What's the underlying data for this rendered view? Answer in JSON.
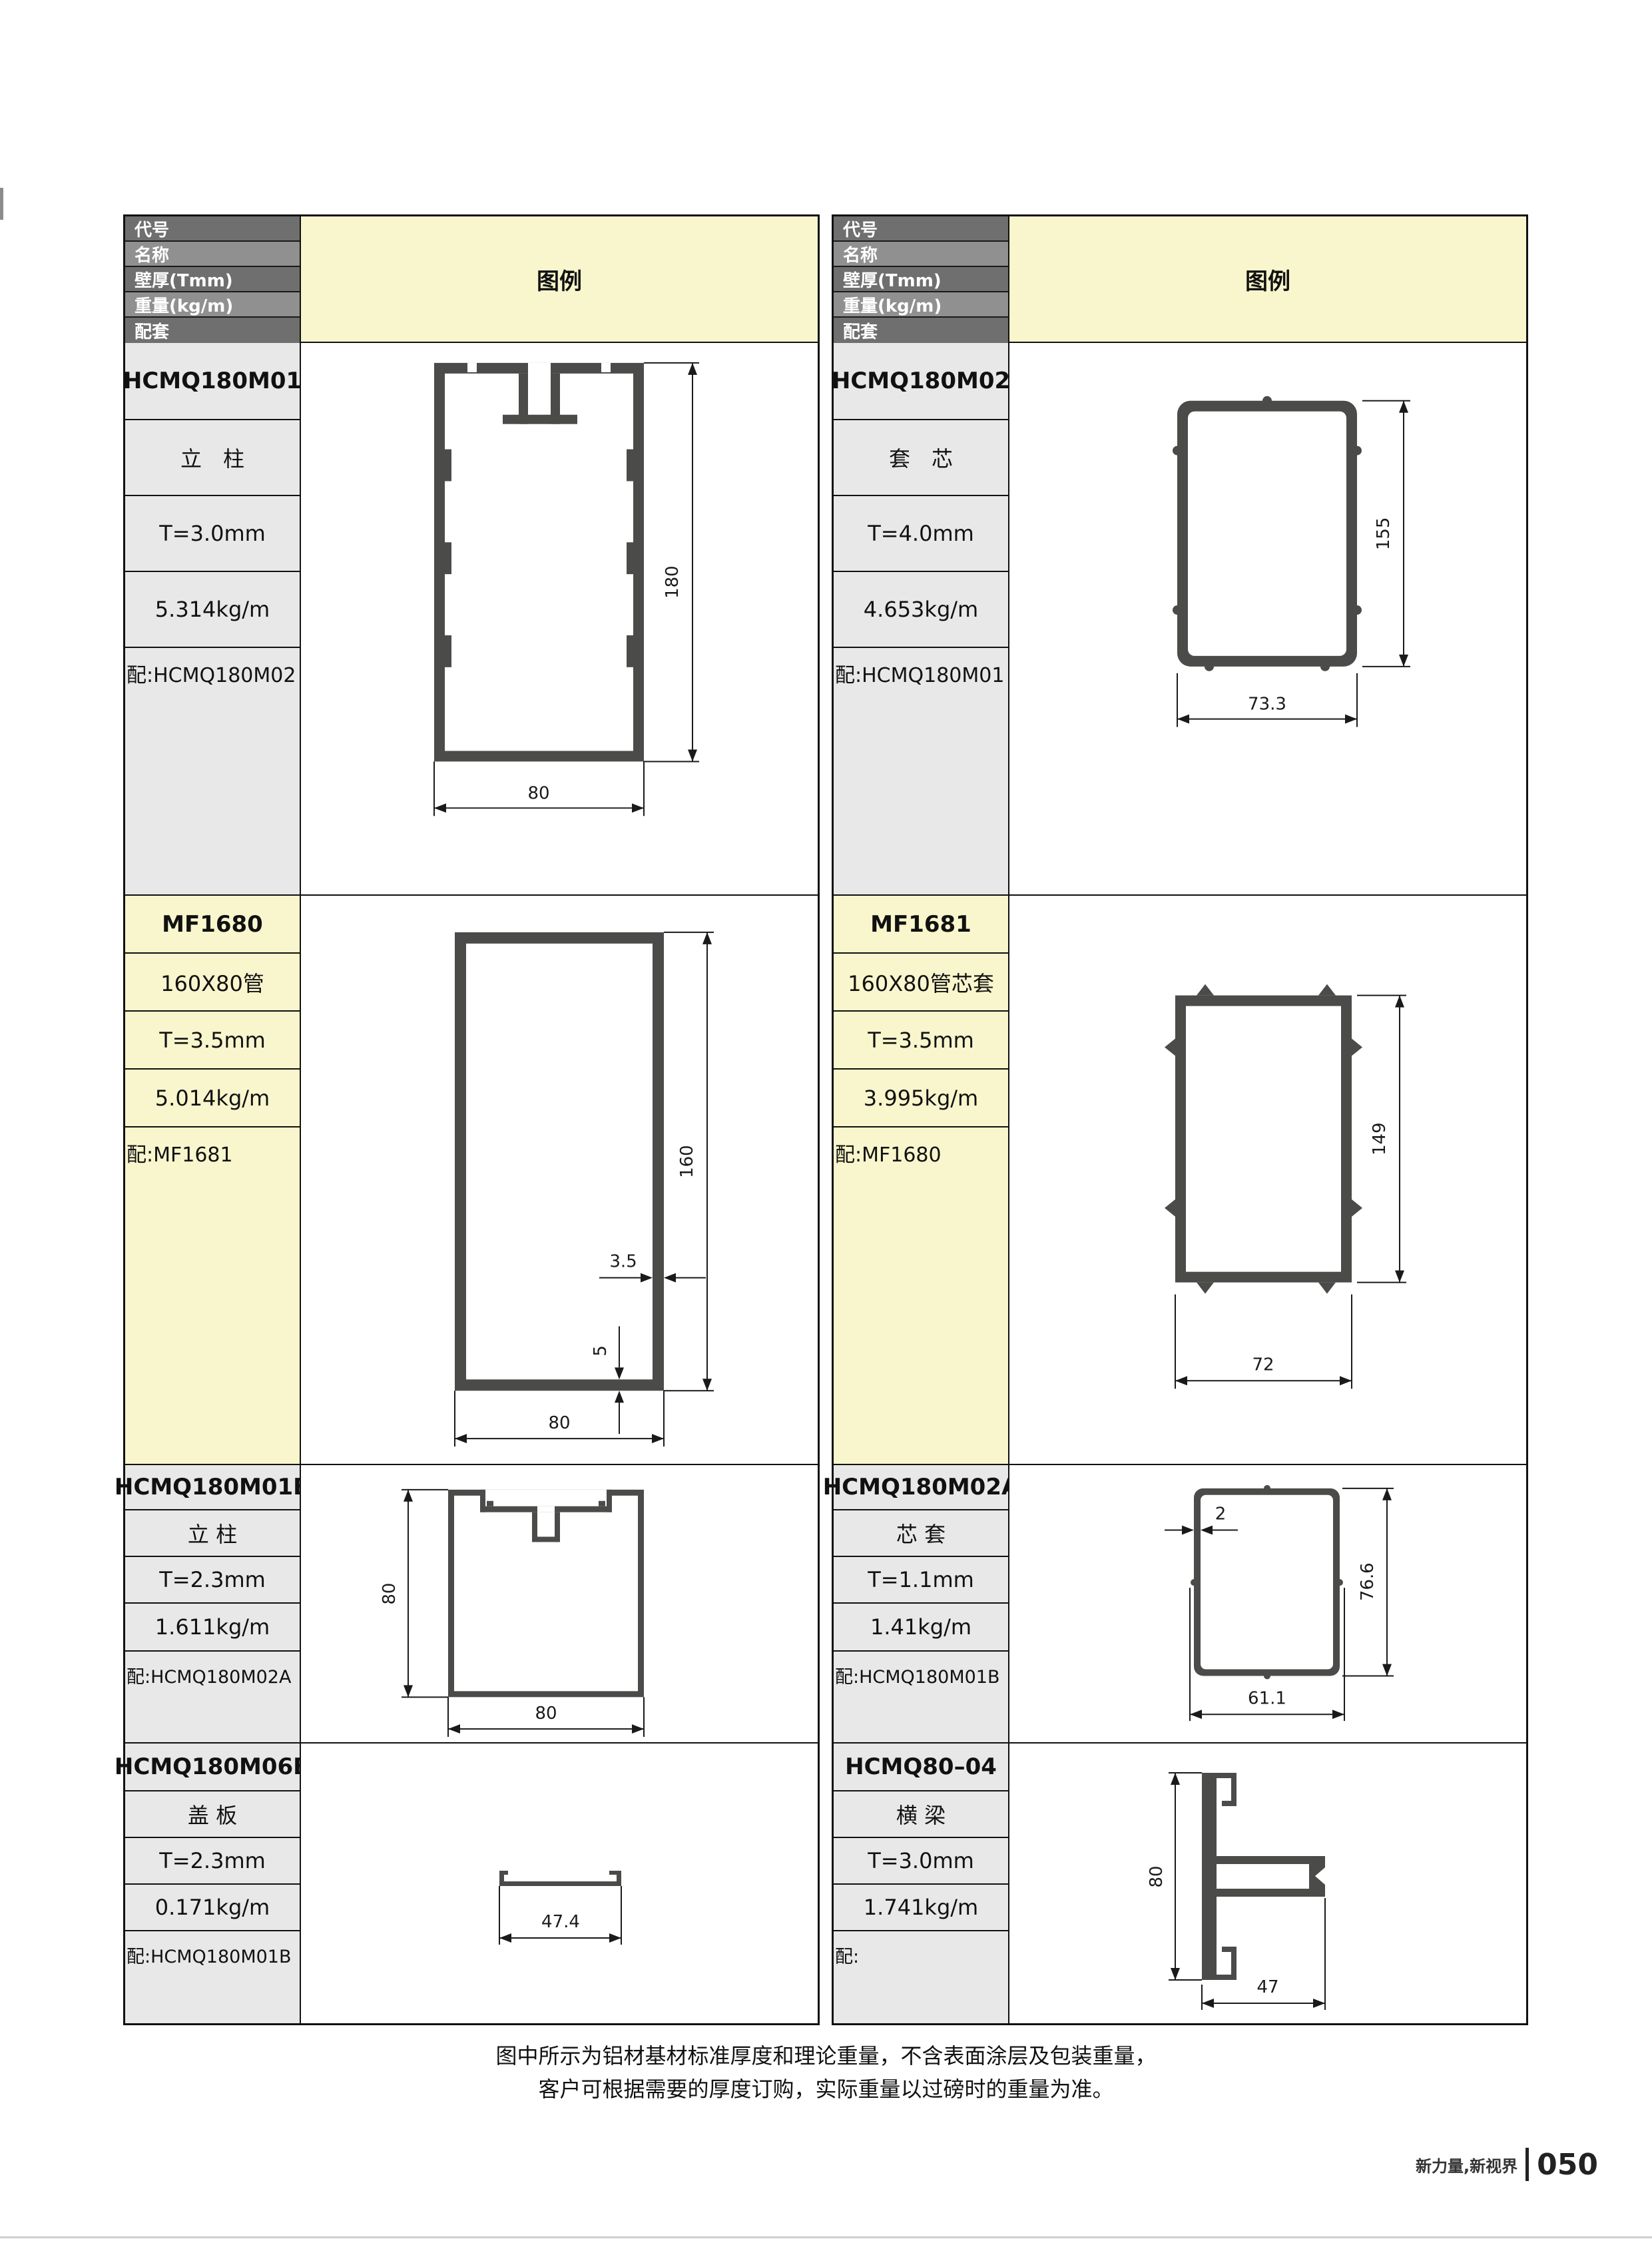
{
  "page": {
    "note_line1": "图中所示为铝材基材标准厚度和理论重量，不含表面涂层及包装重量，",
    "note_line2": "客户可根据需要的厚度订购，实际重量以过磅时的重量为准。",
    "brand": "新力量,新视界",
    "page_number": "050"
  },
  "table": {
    "header": {
      "rows": [
        "代号",
        "名称",
        "壁厚(Tmm)",
        "重量(kg/m)",
        "配套"
      ],
      "legend": "图例"
    },
    "products": [
      {
        "code": "HCMQ180M01",
        "name": "立　柱",
        "thickness": "T=3.0mm",
        "weight": "5.314kg/m",
        "match": "配:HCMQ180M02",
        "dims": {
          "height": "180",
          "width": "80"
        }
      },
      {
        "code": "HCMQ180M02",
        "name": "套　芯",
        "thickness": "T=4.0mm",
        "weight": "4.653kg/m",
        "match": "配:HCMQ180M01",
        "dims": {
          "height": "155",
          "width": "73.3"
        }
      },
      {
        "code": "MF1680",
        "name": "160X80管",
        "thickness": "T=3.5mm",
        "weight": "5.014kg/m",
        "match": "配:MF1681",
        "dims": {
          "height": "160",
          "width": "80",
          "wall": "3.5",
          "bottom": "5"
        }
      },
      {
        "code": "MF1681",
        "name": "160X80管芯套",
        "thickness": "T=3.5mm",
        "weight": "3.995kg/m",
        "match": "配:MF1680",
        "dims": {
          "height": "149",
          "width": "72"
        }
      },
      {
        "code": "HCMQ180M01B",
        "name": "立 柱",
        "thickness": "T=2.3mm",
        "weight": "1.611kg/m",
        "match": "配:HCMQ180M02A",
        "dims": {
          "height": "80",
          "width": "80"
        }
      },
      {
        "code": "HCMQ180M02A",
        "name": "芯 套",
        "thickness": "T=1.1mm",
        "weight": "1.41kg/m",
        "match": "配:HCMQ180M01B",
        "dims": {
          "height": "76.6",
          "width": "61.1",
          "wall": "2"
        }
      },
      {
        "code": "HCMQ180M06B",
        "name": "盖 板",
        "thickness": "T=2.3mm",
        "weight": "0.171kg/m",
        "match": "配:HCMQ180M01B",
        "dims": {
          "width": "47.4"
        }
      },
      {
        "code": "HCMQ80–04",
        "name": "横 梁",
        "thickness": "T=3.0mm",
        "weight": "1.741kg/m",
        "match": "配:",
        "dims": {
          "height": "80",
          "width": "47"
        }
      }
    ],
    "colors": {
      "header_dark": "#6f6f6f",
      "header_light": "#909090",
      "legend_yellow": "#f9f6cd",
      "row_gray": "#e8e8e8",
      "profile_fill": "#4b4b49"
    }
  }
}
